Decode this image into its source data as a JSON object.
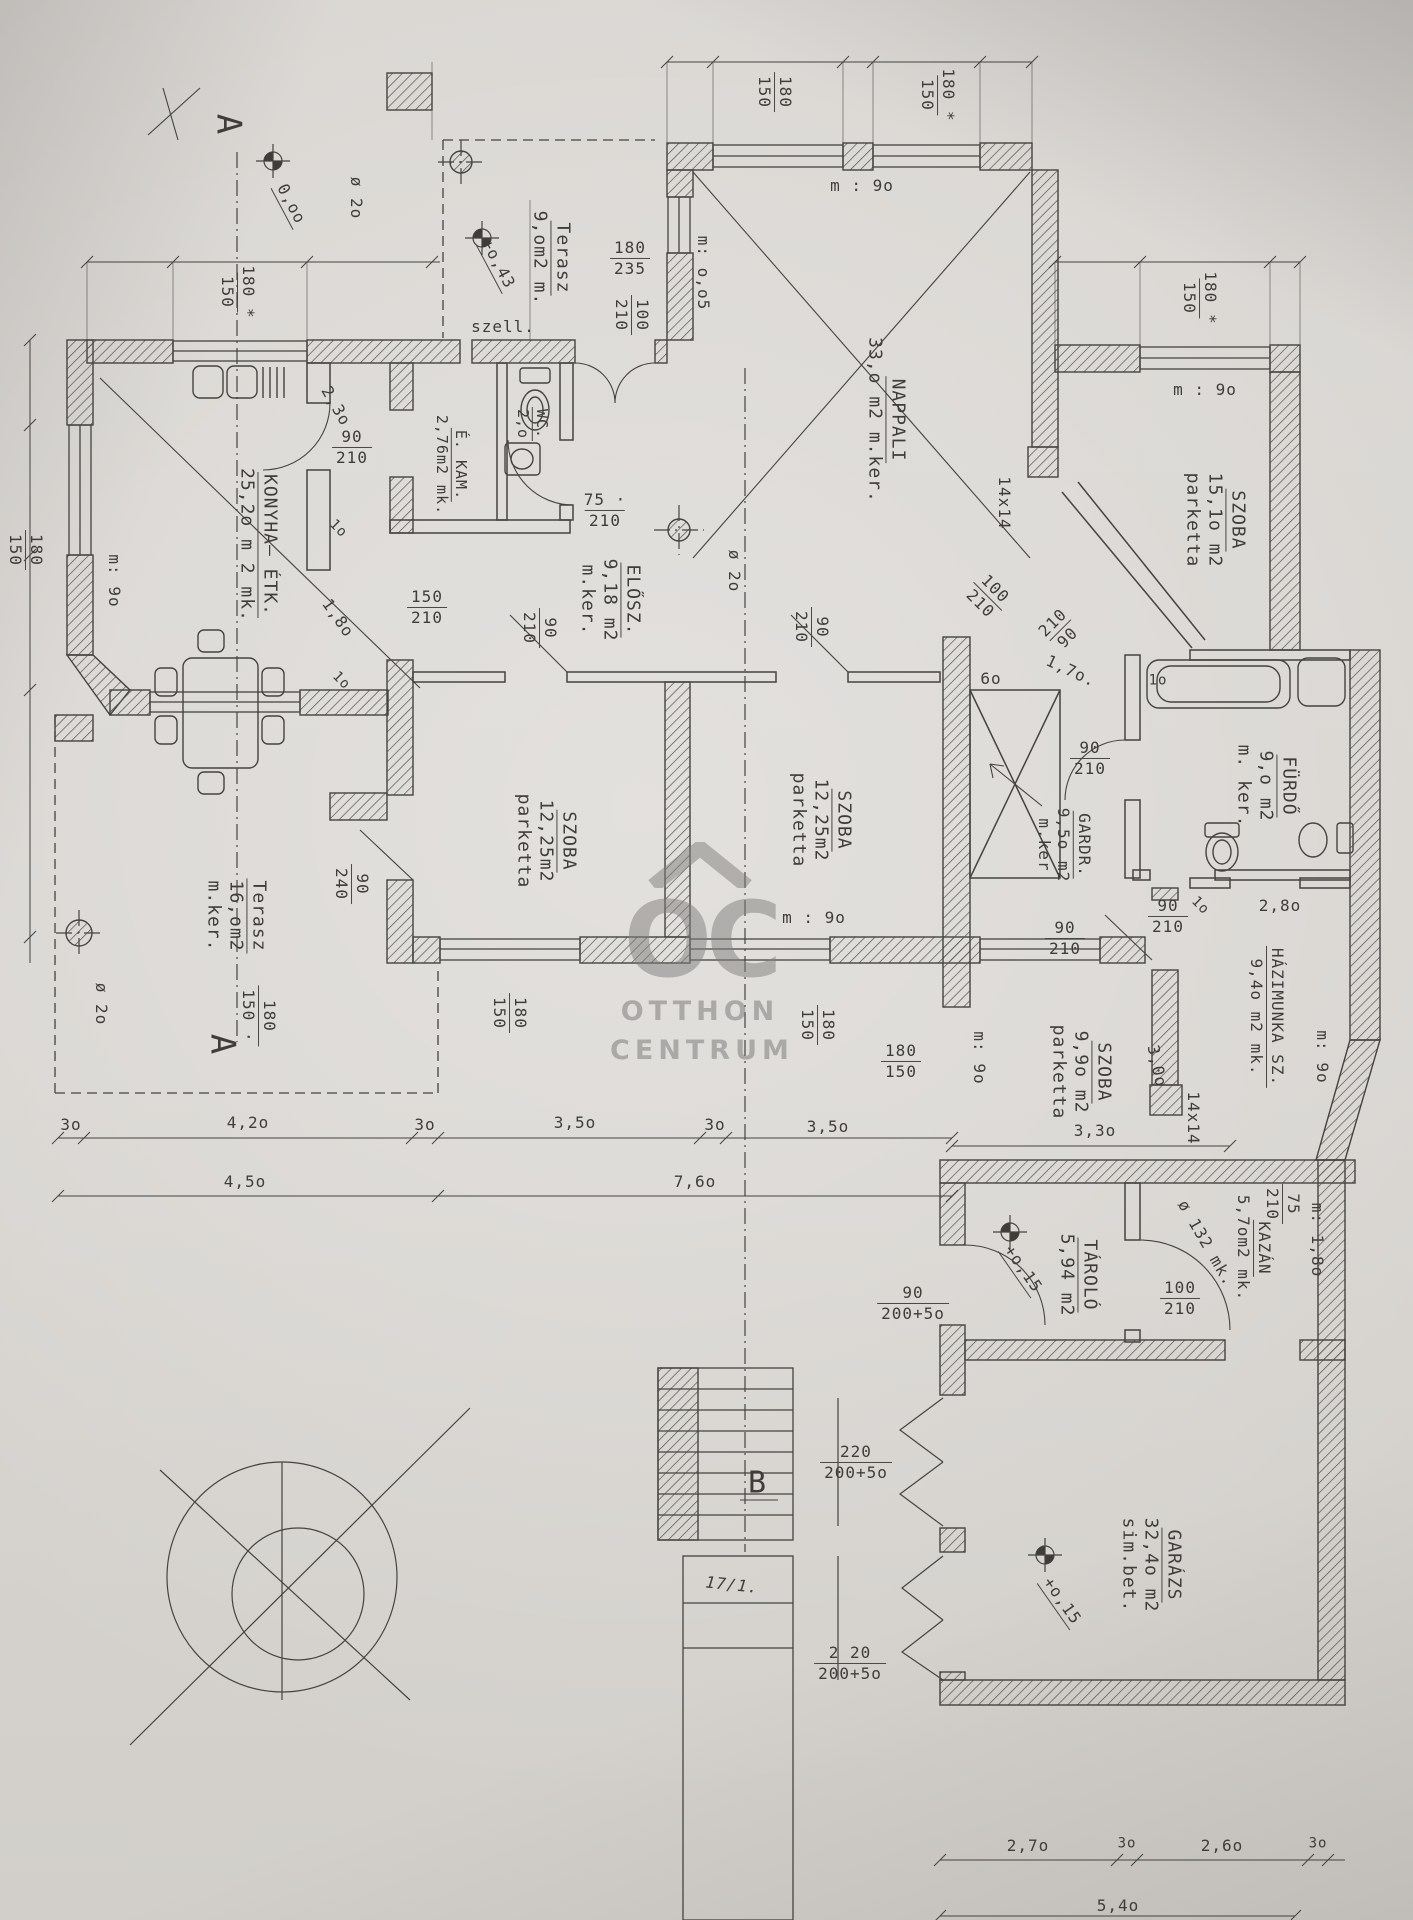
{
  "palette": {
    "paper": "#d8d5d1",
    "ink": "#3f3d39",
    "watermark": "#807e7b"
  },
  "watermark": {
    "monogram": "OC",
    "line1": "OTTHON",
    "line2": "CENTRUM"
  },
  "markers": {
    "section_a_top": "A",
    "section_a_bottom": "A",
    "section_b": "B"
  },
  "stamp": {
    "note": "17/1."
  },
  "rooms": {
    "terasz_top": {
      "name": "Terasz",
      "l2": "9,om2 m."
    },
    "nappali": {
      "name": "NAPPALI",
      "l2": "33,o m2 m.ker."
    },
    "konyha": {
      "name": "KONYHA– ÉTK.",
      "l2": "25,2o m 2 mk."
    },
    "ekam": {
      "name": "É. KAM.",
      "l2": "2,76m2 mk."
    },
    "wc": {
      "name": "WC.",
      "l2": "2,o"
    },
    "elosz": {
      "name": "ELŐSZ.",
      "l2": "9,18 m2",
      "l3": "m.ker."
    },
    "szoba1": {
      "name": "SZOBA",
      "l2": "12,25m2",
      "l3": "parketta"
    },
    "szoba2": {
      "name": "SZOBA",
      "l2": "12,25m2",
      "l3": "parketta"
    },
    "szoba3": {
      "name": "SZOBA",
      "l2": "15,1o m2",
      "l3": "parketta"
    },
    "furdo": {
      "name": "FÜRDŐ",
      "l2": "9,o m2",
      "l3": "m. ker."
    },
    "gardr": {
      "name": "GARDR.",
      "l2": "9,5o m2",
      "l3": "m.ker"
    },
    "szoba4": {
      "name": "SZOBA",
      "l2": "9,9o m2",
      "l3": "parketta"
    },
    "hazimunka": {
      "name": "HÁZIMUNKA SZ.",
      "l2": "9,4o m2 mk."
    },
    "tarolo": {
      "name": "TÁROLÓ",
      "l2": "5,94 m2"
    },
    "kazan": {
      "name": "KAZÁN",
      "l2": "5,7om2 mk."
    },
    "garazs": {
      "name": "GARÁZS",
      "l2": "32,4o m2",
      "l3": "sim.bet."
    },
    "terasz_bottom": {
      "name": "Terasz",
      "l2": "16,om2",
      "l3": "m.ker."
    }
  },
  "dims": {
    "d01": {
      "t": "180 *",
      "b": "150"
    },
    "d02": {
      "t": "180",
      "b": "235"
    },
    "d03": {
      "t": "100",
      "b": "210"
    },
    "d04": {
      "t": "180",
      "b": "150"
    },
    "d05": {
      "t": "180 *",
      "b": "150"
    },
    "d06": {
      "t": "180 *",
      "b": "150"
    },
    "d07": {
      "t": "90",
      "b": "210"
    },
    "d08": {
      "t": "75 ·",
      "b": "210"
    },
    "d09": {
      "t": "150",
      "b": "210"
    },
    "d10": {
      "t": "90",
      "b": "210"
    },
    "d11": {
      "t": "90",
      "b": "210"
    },
    "d12": {
      "t": "100",
      "b": "210"
    },
    "d13": {
      "t": "210",
      "b": "90"
    },
    "d14": {
      "t": "90",
      "b": "210"
    },
    "d16": {
      "t": "90",
      "b": "210"
    },
    "d17": {
      "t": "90",
      "b": "210"
    },
    "d18": {
      "t": "180",
      "b": "150"
    },
    "d19": {
      "t": "180",
      "b": "150"
    },
    "d20": {
      "t": "180",
      "b": "150"
    },
    "d21": {
      "t": "180",
      "b": "150 ·"
    },
    "d22": {
      "t": "90",
      "b": "240"
    },
    "d23": {
      "t": "100",
      "b": "210"
    },
    "d24": {
      "t": "75",
      "b": "210"
    },
    "d25": {
      "t": "90",
      "b": "200+5o"
    },
    "d26": {
      "t": "220",
      "b": "200+5o"
    },
    "d27": {
      "t": "2 20",
      "b": "200+5o"
    },
    "d28": {
      "t": "180",
      "b": "150"
    }
  },
  "texts": {
    "level_000": "0,oo",
    "level_043": "+o,43",
    "level_015a": "+o,15",
    "level_015b": "+o,15",
    "m_005": "m: o,o5",
    "m9_nappali": "m : 9o",
    "m9_szoba3": "m : 9o",
    "m9_konyha": "m: 9o",
    "m9_szoba2": "m : 9o",
    "m9_szoba4": "m: 9o",
    "m9_hazimunka": "m: 9o",
    "m18_kazan": "m: 1,8o",
    "szell": "szell.",
    "dia20_a": "ø 2o",
    "dia20_b": "ø 2o",
    "dia20_c": "ø 2o",
    "dia132": "ø 132 mk.",
    "chimney1": "14x14",
    "chimney2": "14x14",
    "w230": "2,3o",
    "w180": "1,8o",
    "d1o_a": "1o",
    "d1o_b": "1o",
    "d1o_tub": "1o",
    "d1o_d": "1o",
    "w60": "6o",
    "w170": "1,7o.",
    "w280": "2,8o",
    "w350": "3,5o",
    "w330": "3,3o",
    "w300": "3,0o",
    "c_3o_1": "3o",
    "c_42": "4,2o",
    "c_3o_2": "3o",
    "c_35": "3,5o",
    "c_3o_3": "3o",
    "c_35b": "3,5o",
    "c_45": "4,5o",
    "c_76": "7,6o",
    "g_27": "2,7o",
    "g_3oa": "3o",
    "g_26": "2,6o",
    "g_3ob": "3o",
    "g_54": "5,4o"
  }
}
